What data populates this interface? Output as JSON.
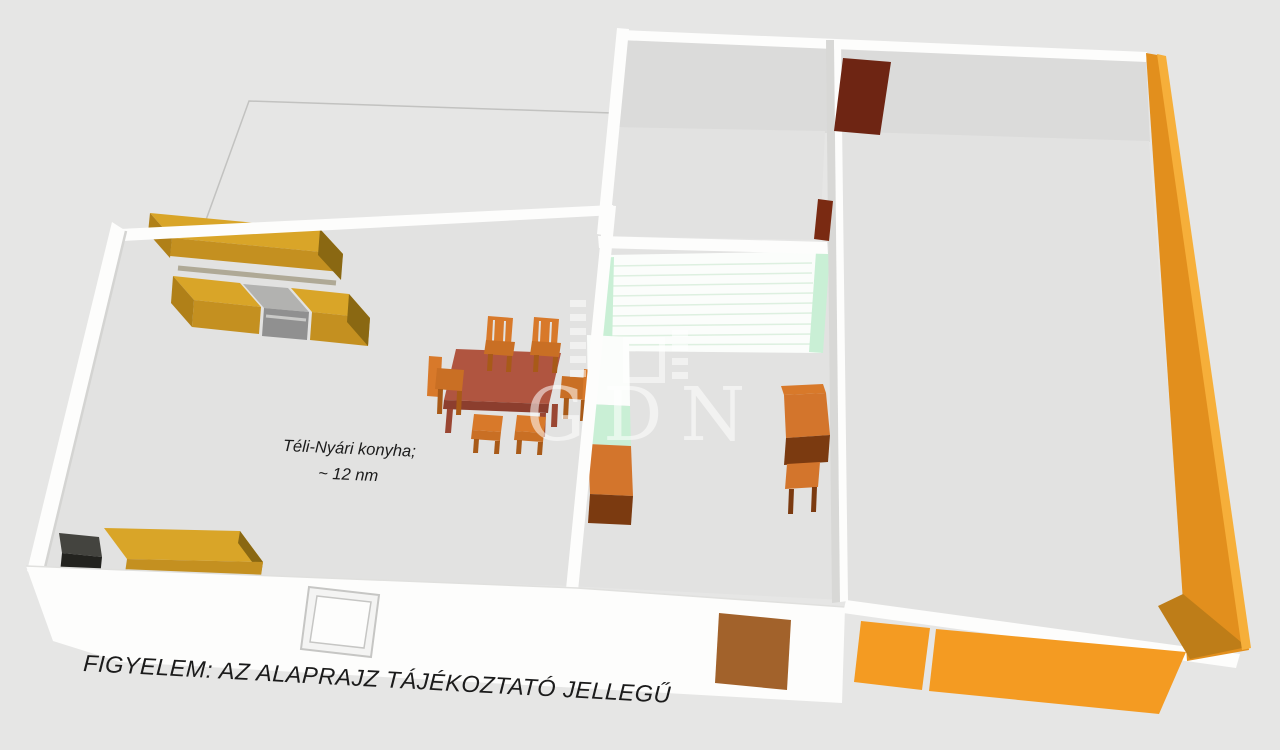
{
  "labels": {
    "room_label_line1": "Téli-Nyári konyha;",
    "room_label_line2": "~ 12 nm",
    "disclaimer": "FIGYELEM: AZ ALAPRAJZ TÁJÉKOZTATÓ JELLEGŰ",
    "watermark_text": "GDN"
  },
  "palette": {
    "background": "#E6E6E5",
    "floor": "#E2E2E1",
    "wall_face": "#DBDBDA",
    "wall_white": "#FDFDFC",
    "wall_shade": "#D8D8D6",
    "cabinet_yellow_top": "#D9A528",
    "cabinet_yellow_front": "#C49020",
    "cabinet_yellow_side": "#B08018",
    "cabinet_yellow_dark": "#8A6812",
    "appliance_gray_top": "#B2B2B0",
    "appliance_gray_front": "#909090",
    "table_top": "#B05540",
    "table_edge": "#8C3E2E",
    "table_leg": "#9A4632",
    "chair_orange": "#D8792A",
    "chair_seat": "#C96F24",
    "chair_leg": "#A85A18",
    "dresser_orange": "#D3752C",
    "dresser_front_dark": "#7B3A10",
    "stair_white": "#FBFDFB",
    "stair_stripe": "#DDF0E0",
    "stair_green": "#C9EFD5",
    "door_dark_red": "#6E2513",
    "door_red_small": "#7A2A12",
    "door_brown": "#A2622B",
    "wall_orange": "#E28F1D",
    "wall_orange_bright": "#F6AF3A",
    "wall_orange_dark": "#BE7D18",
    "front_strip_orange": "#F49B22",
    "black_box_top": "#44443F",
    "black_box_front": "#23231F",
    "text_color": "#1B1B1B",
    "watermark": "rgba(255,255,255,0.55)"
  }
}
